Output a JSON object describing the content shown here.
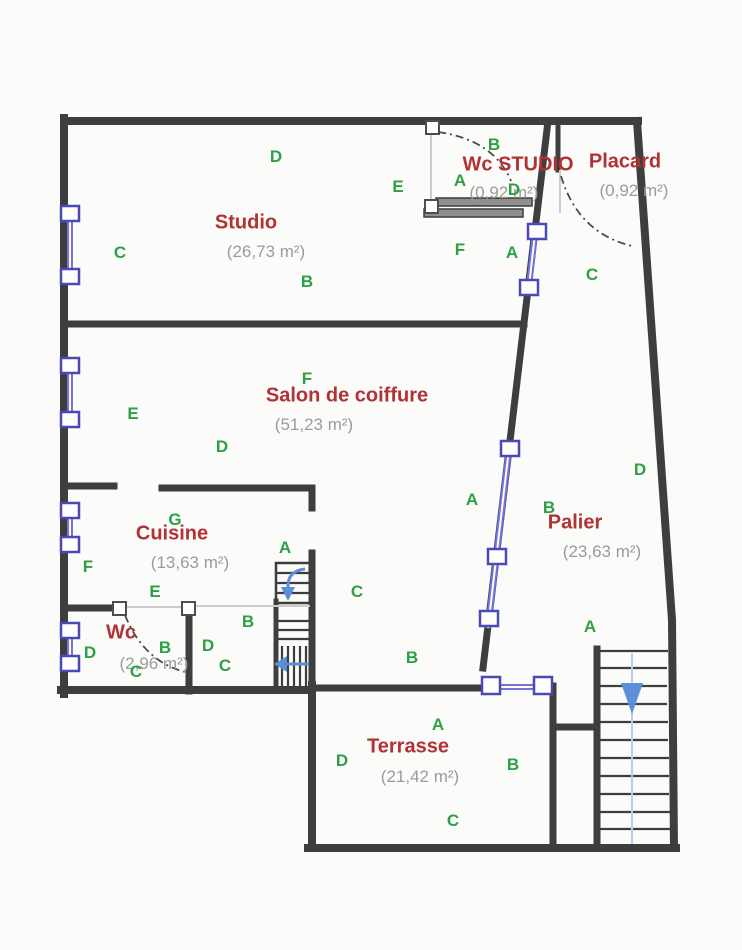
{
  "title": "Floor plan",
  "colors": {
    "wall": "#3e3e3e",
    "window_blue": "#7472dd",
    "window_border": "#4a49b5",
    "letter_green": "#2da046",
    "room_name_red": "#b23134",
    "area_gray": "#9b9b9b",
    "stair_arrow": "#5b8fd8",
    "stair_guide": "#b7cde8",
    "background": "#fbfbf9"
  },
  "rooms": [
    {
      "id": "studio",
      "name": "Studio",
      "area": "(26,73 m²)",
      "nx": 246,
      "ny": 223,
      "ax": 266,
      "ay": 252
    },
    {
      "id": "wc-studio",
      "name": "Wc STUDIO",
      "area": "(0,92 m²)",
      "nx": 518,
      "ny": 165,
      "ax": 504,
      "ay": 193
    },
    {
      "id": "placard",
      "name": "Placard",
      "area": "(0,92 m²)",
      "nx": 625,
      "ny": 162,
      "ax": 634,
      "ay": 191
    },
    {
      "id": "salon",
      "name": "Salon de coiffure",
      "area": "(51,23 m²)",
      "nx": 347,
      "ny": 396,
      "ax": 314,
      "ay": 425
    },
    {
      "id": "cuisine",
      "name": "Cuisine",
      "area": "(13,63 m²)",
      "nx": 172,
      "ny": 534,
      "ax": 190,
      "ay": 563
    },
    {
      "id": "wc",
      "name": "Wc",
      "area": "(2,96 m²)",
      "nx": 121,
      "ny": 633,
      "ax": 154,
      "ay": 664
    },
    {
      "id": "palier",
      "name": "Palier",
      "area": "(23,63 m²)",
      "nx": 575,
      "ny": 523,
      "ax": 602,
      "ay": 552
    },
    {
      "id": "terrasse",
      "name": "Terrasse",
      "area": "(21,42 m²)",
      "nx": 408,
      "ny": 747,
      "ax": 420,
      "ay": 777
    }
  ],
  "letters": [
    {
      "t": "D",
      "x": 276,
      "y": 157
    },
    {
      "t": "B",
      "x": 494,
      "y": 145
    },
    {
      "t": "E",
      "x": 398,
      "y": 187
    },
    {
      "t": "A",
      "x": 460,
      "y": 181
    },
    {
      "t": "D",
      "x": 514,
      "y": 190
    },
    {
      "t": "C",
      "x": 120,
      "y": 253
    },
    {
      "t": "B",
      "x": 307,
      "y": 282
    },
    {
      "t": "F",
      "x": 460,
      "y": 250
    },
    {
      "t": "A",
      "x": 512,
      "y": 253
    },
    {
      "t": "C",
      "x": 592,
      "y": 275
    },
    {
      "t": "F",
      "x": 307,
      "y": 379
    },
    {
      "t": "E",
      "x": 133,
      "y": 414
    },
    {
      "t": "D",
      "x": 222,
      "y": 447
    },
    {
      "t": "G",
      "x": 175,
      "y": 520
    },
    {
      "t": "A",
      "x": 285,
      "y": 548
    },
    {
      "t": "F",
      "x": 88,
      "y": 567
    },
    {
      "t": "E",
      "x": 155,
      "y": 592
    },
    {
      "t": "C",
      "x": 357,
      "y": 592
    },
    {
      "t": "B",
      "x": 248,
      "y": 622
    },
    {
      "t": "A",
      "x": 590,
      "y": 627
    },
    {
      "t": "B",
      "x": 412,
      "y": 658
    },
    {
      "t": "D",
      "x": 90,
      "y": 653
    },
    {
      "t": "B",
      "x": 165,
      "y": 648
    },
    {
      "t": "D",
      "x": 208,
      "y": 646
    },
    {
      "t": "C",
      "x": 225,
      "y": 666
    },
    {
      "t": "C",
      "x": 136,
      "y": 672
    },
    {
      "t": "A",
      "x": 472,
      "y": 500
    },
    {
      "t": "B",
      "x": 549,
      "y": 508
    },
    {
      "t": "D",
      "x": 640,
      "y": 470
    },
    {
      "t": "A",
      "x": 438,
      "y": 725
    },
    {
      "t": "D",
      "x": 342,
      "y": 761
    },
    {
      "t": "B",
      "x": 513,
      "y": 765
    },
    {
      "t": "C",
      "x": 453,
      "y": 821
    }
  ]
}
